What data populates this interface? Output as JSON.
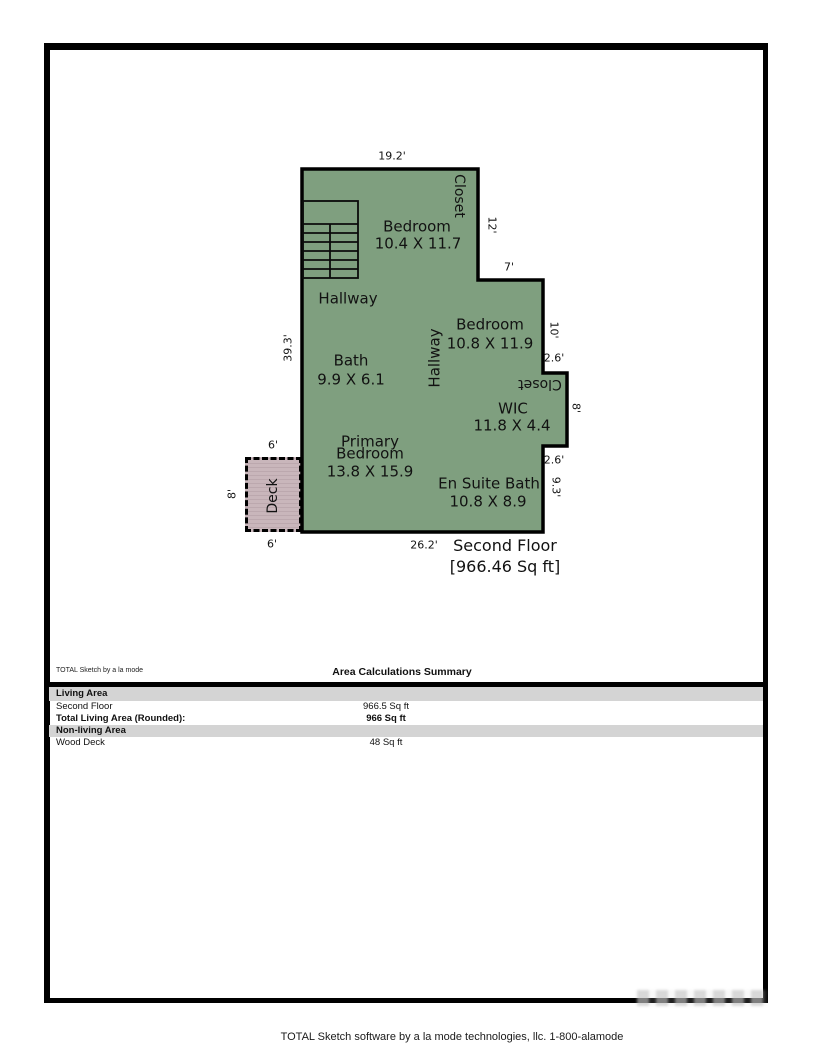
{
  "colors": {
    "area_fill": "#7F9F7F",
    "deck_fill": "#C9B6BB",
    "deck_stripe": "#BCA8AE",
    "wall": "#000000",
    "band_gray": "#D4D4D4"
  },
  "plan": {
    "dim_top_width": "19.2'",
    "closet_top": "Closet",
    "bedroom1": "Bedroom",
    "bedroom1_dims": "10.4 X 11.7",
    "dim_right_12": "12'",
    "dim_step_7": "7'",
    "hallway_upper": "Hallway",
    "bedroom2": "Bedroom",
    "bedroom2_dims": "10.8 X 11.9",
    "hallway_vertical": "Hallway",
    "dim_right_10": "10'",
    "dim_step_2_6_upper": "2.6'",
    "closet_mid": "Closet",
    "dim_right_8": "8'",
    "wic": "WIC",
    "wic_dims": "11.8 X 4.4",
    "dim_left_39_3": "39.3'",
    "bath": "Bath",
    "bath_dims": "9.9 X 6.1",
    "dim_deck_top_6": "6'",
    "primary_bedroom_line1": "Primary",
    "primary_bedroom_line2": "Bedroom",
    "primary_bedroom_dims": "13.8 X 15.9",
    "dim_step_2_6_lower": "2.6'",
    "ensuite": "En Suite Bath",
    "ensuite_dims": "10.8 X 8.9",
    "dim_right_9_3": "9.3'",
    "deck": "Deck",
    "dim_deck_left_8": "8'",
    "dim_deck_bottom_6": "6'",
    "dim_bottom_26_2": "26.2'",
    "floor_name": "Second Floor",
    "floor_area": "[966.46 Sq ft]"
  },
  "summary": {
    "brand": "TOTAL Sketch by a la mode",
    "title": "Area Calculations Summary",
    "sections": [
      {
        "header": "Living Area",
        "rows": [
          {
            "label": "Second Floor",
            "value": "966.5 Sq ft"
          },
          {
            "label": "Total Living Area (Rounded):",
            "value": "966 Sq ft"
          }
        ]
      },
      {
        "header": "Non-living Area",
        "rows": [
          {
            "label": "Wood Deck",
            "value": "48 Sq ft"
          }
        ]
      }
    ]
  },
  "footer": "TOTAL Sketch software by a la mode technologies, llc. 1-800-alamode"
}
